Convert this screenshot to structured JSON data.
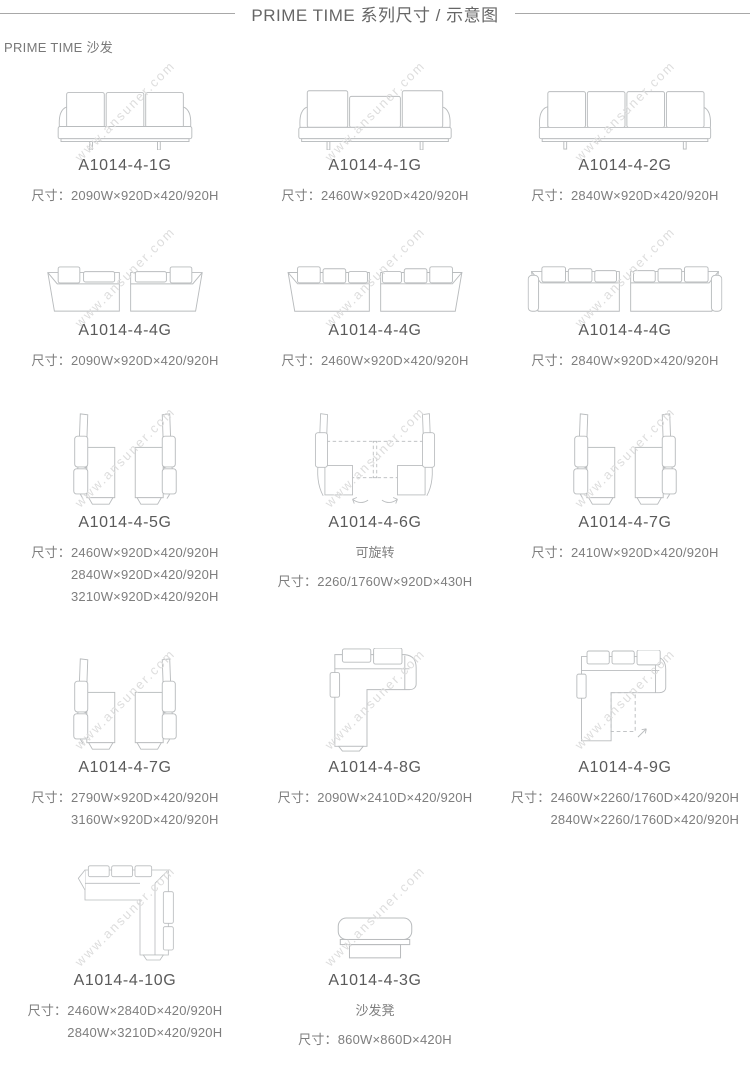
{
  "page": {
    "title": "PRIME TIME  系列尺寸 / 示意图",
    "subtitle": "PRIME TIME 沙发",
    "watermark": "www.ansuner.com",
    "dim_prefix": "尺寸："
  },
  "colors": {
    "title_text": "#666666",
    "model_text": "#5a5a5a",
    "dims_text": "#7e7e7e",
    "line_art": "#b9bcbe",
    "watermark": "#dddddd",
    "rule": "#a8a8a8"
  },
  "items": [
    {
      "model": "A1014-4-1G",
      "drawing": "sofa-front-view-3-cushions",
      "dims": [
        "2090W×920D×420/920H"
      ]
    },
    {
      "model": "A1014-4-1G",
      "drawing": "sofa-front-view-wide-center-cushion",
      "dims": [
        "2460W×920D×420/920H"
      ]
    },
    {
      "model": "A1014-4-2G",
      "drawing": "sofa-front-view-4-cushions",
      "dims": [
        "2840W×920D×420/920H"
      ]
    },
    {
      "model": "A1014-4-4G",
      "drawing": "sofa-pair-top-view",
      "dims": [
        "2090W×920D×420/920H"
      ]
    },
    {
      "model": "A1014-4-4G",
      "drawing": "sofa-pair-top-view",
      "dims": [
        "2460W×920D×420/920H"
      ]
    },
    {
      "model": "A1014-4-4G",
      "drawing": "sofa-pair-top-view",
      "dims": [
        "2840W×920D×420/920H"
      ]
    },
    {
      "model": "A1014-4-5G",
      "drawing": "chaise-pair-side-view",
      "dims": [
        "2460W×920D×420/920H",
        "2840W×920D×420/920H",
        "3210W×920D×420/920H"
      ]
    },
    {
      "model": "A1014-4-6G",
      "note": "可旋转",
      "drawing": "rotatable-chaise-pair",
      "dims": [
        "2260/1760W×920D×430H"
      ]
    },
    {
      "model": "A1014-4-7G",
      "drawing": "chaise-pair-side-view",
      "dims": [
        "2410W×920D×420/920H"
      ]
    },
    {
      "model": "A1014-4-7G",
      "drawing": "chaise-pair-side-view",
      "dims": [
        "2790W×920D×420/920H",
        "3160W×920D×420/920H"
      ]
    },
    {
      "model": "A1014-4-8G",
      "drawing": "corner-sofa-top-view",
      "dims": [
        "2090W×2410D×420/920H"
      ]
    },
    {
      "model": "A1014-4-9G",
      "drawing": "corner-sofa-rotatable-chaise-top-view",
      "dims": [
        "2460W×2260/1760D×420/920H",
        "2840W×2260/1760D×420/920H"
      ]
    },
    {
      "model": "A1014-4-10G",
      "drawing": "corner-sofa-top-view-right-chaise",
      "dims": [
        "2460W×2840D×420/920H",
        "2840W×3210D×420/920H"
      ]
    },
    {
      "model": "A1014-4-3G",
      "note": "沙发凳",
      "drawing": "ottoman-front-view",
      "dims": [
        "860W×860D×420H"
      ]
    }
  ]
}
